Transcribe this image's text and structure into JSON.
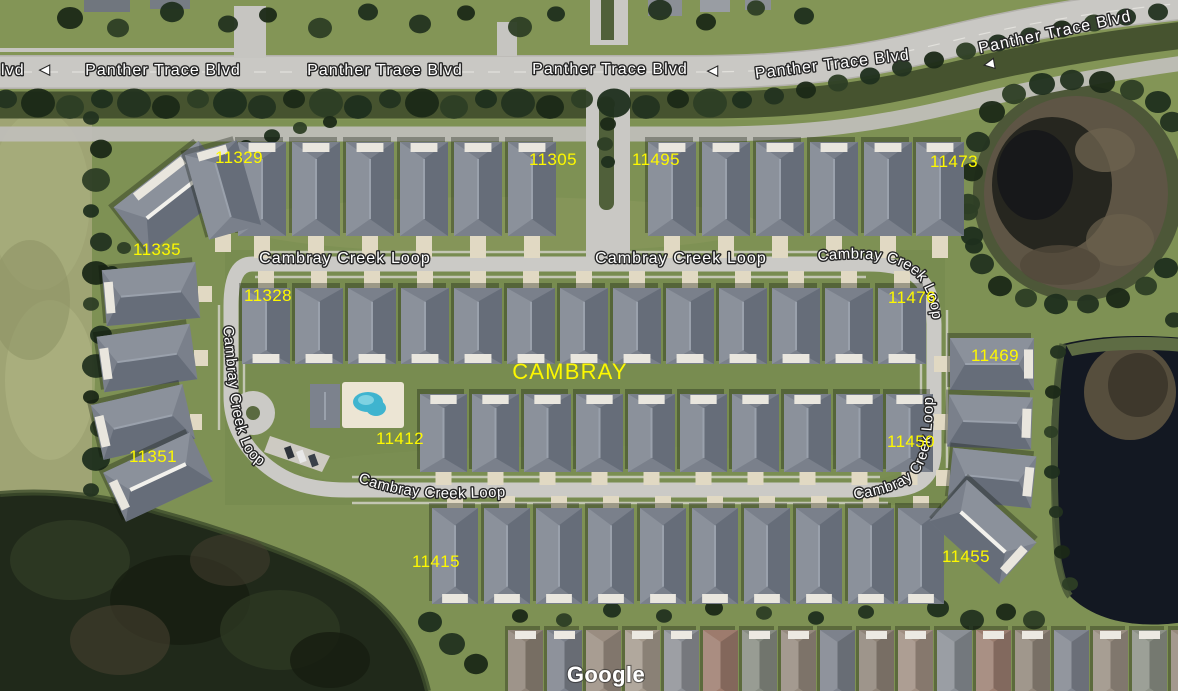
{
  "map_attribution": {
    "watermark": "Google"
  },
  "area_label": {
    "text": "CAMBRAY"
  },
  "streets": {
    "panther_trace": "Panther Trace Blvd",
    "cambray_creek": "Cambray Creek Loop"
  },
  "street_labels": [
    {
      "text": "lvd",
      "x": 1,
      "y": 75,
      "rot": 0,
      "anchor": "start"
    },
    {
      "text": "Panther Trace Blvd",
      "x": 163,
      "y": 75,
      "rot": 0
    },
    {
      "text": "Panther Trace Blvd",
      "x": 385,
      "y": 75,
      "rot": 0
    },
    {
      "text": "Panther Trace Blvd",
      "x": 610,
      "y": 74,
      "rot": 0
    },
    {
      "text": "Panther Trace Blvd",
      "x": 833,
      "y": 69,
      "rot": -7
    },
    {
      "text": "Panther Trace Blvd",
      "x": 1056,
      "y": 37,
      "rot": -12
    },
    {
      "text": "Cambray Creek Loop",
      "x": 345,
      "y": 263,
      "rot": 0
    },
    {
      "text": "Cambray Creek Loop",
      "x": 681,
      "y": 263,
      "rot": 0
    }
  ],
  "curved_street_labels": [
    {
      "text": "Cambray Creek Loop",
      "path_id": "cp-left",
      "offset": 2
    },
    {
      "text": "Cambray Creek Loop",
      "path_id": "cp-topright",
      "offset": 0
    },
    {
      "text": "Cambray Creek Loop",
      "path_id": "cp-rightdown",
      "offset": 0
    },
    {
      "text": "Cambray Creek Loop",
      "path_id": "cp-bottom",
      "offset": 2
    }
  ],
  "direction_arrows": [
    {
      "x": 45,
      "y": 73,
      "rot": 0
    },
    {
      "x": 713,
      "y": 74,
      "rot": 0
    },
    {
      "x": 990,
      "y": 67,
      "rot": -10
    }
  ],
  "house_numbers": [
    {
      "text": "11329",
      "x": 239,
      "y": 163
    },
    {
      "text": "11305",
      "x": 553,
      "y": 165
    },
    {
      "text": "11495",
      "x": 656,
      "y": 165
    },
    {
      "text": "11473",
      "x": 954,
      "y": 167
    },
    {
      "text": "11335",
      "x": 157,
      "y": 255
    },
    {
      "text": "11328",
      "x": 268,
      "y": 301
    },
    {
      "text": "11476",
      "x": 912,
      "y": 303
    },
    {
      "text": "11469",
      "x": 995,
      "y": 361
    },
    {
      "text": "11412",
      "x": 400,
      "y": 444
    },
    {
      "text": "11450",
      "x": 911,
      "y": 447
    },
    {
      "text": "11351",
      "x": 153,
      "y": 462
    },
    {
      "text": "11415",
      "x": 436,
      "y": 567
    },
    {
      "text": "11455",
      "x": 966,
      "y": 562
    }
  ],
  "colors": {
    "house_number_label": "#fdf800",
    "area_label": "#fdf800",
    "street_label_fill": "#ffffff",
    "street_label_halo": "#262626",
    "watermark": "#ffffff"
  },
  "icons": {
    "direction_arrow": "◀"
  }
}
